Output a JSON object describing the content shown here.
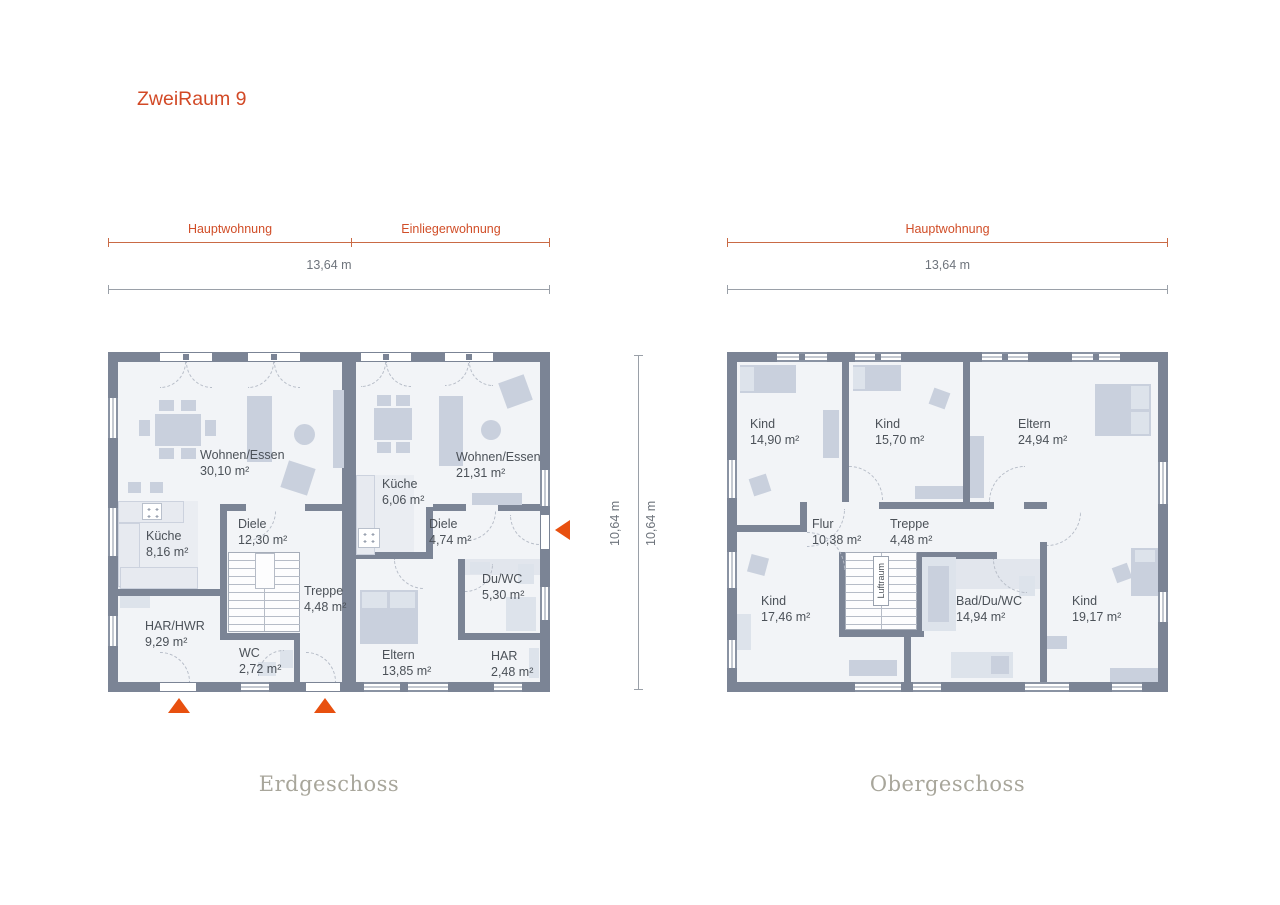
{
  "title": "ZweiRaum 9",
  "accent_color": "#d14e28",
  "wall_color": "#7b8495",
  "dimensions": {
    "left_top_segments": [
      "Hauptwohnung",
      "Einliegerwohnung"
    ],
    "left_total": "13,64 m",
    "right_top_segments": [
      "Hauptwohnung"
    ],
    "right_total": "13,64 m",
    "vertical_left": "10,64 m",
    "vertical_right": "10,64 m"
  },
  "floors": [
    {
      "name": "Erdgeschoss",
      "rooms": [
        {
          "name": "Wohnen/Essen",
          "area": "30,10 m²"
        },
        {
          "name": "Küche",
          "area": "8,16 m²"
        },
        {
          "name": "Diele",
          "area": "12,30 m²"
        },
        {
          "name": "Treppe",
          "area": "4,48 m²"
        },
        {
          "name": "HAR/HWR",
          "area": "9,29 m²"
        },
        {
          "name": "WC",
          "area": "2,72 m²"
        },
        {
          "name": "Küche",
          "area": "6,06 m²"
        },
        {
          "name": "Wohnen/Essen",
          "area": "21,31 m²"
        },
        {
          "name": "Diele",
          "area": "4,74 m²"
        },
        {
          "name": "Du/WC",
          "area": "5,30 m²"
        },
        {
          "name": "Eltern",
          "area": "13,85 m²"
        },
        {
          "name": "HAR",
          "area": "2,48 m²"
        }
      ]
    },
    {
      "name": "Obergeschoss",
      "void_label": "Luftraum",
      "rooms": [
        {
          "name": "Kind",
          "area": "14,90 m²"
        },
        {
          "name": "Kind",
          "area": "15,70 m²"
        },
        {
          "name": "Eltern",
          "area": "24,94 m²"
        },
        {
          "name": "Flur",
          "area": "10,38 m²"
        },
        {
          "name": "Treppe",
          "area": "4,48 m²"
        },
        {
          "name": "Kind",
          "area": "17,46 m²"
        },
        {
          "name": "Bad/Du/WC",
          "area": "14,94 m²"
        },
        {
          "name": "Kind",
          "area": "19,17 m²"
        }
      ]
    }
  ]
}
